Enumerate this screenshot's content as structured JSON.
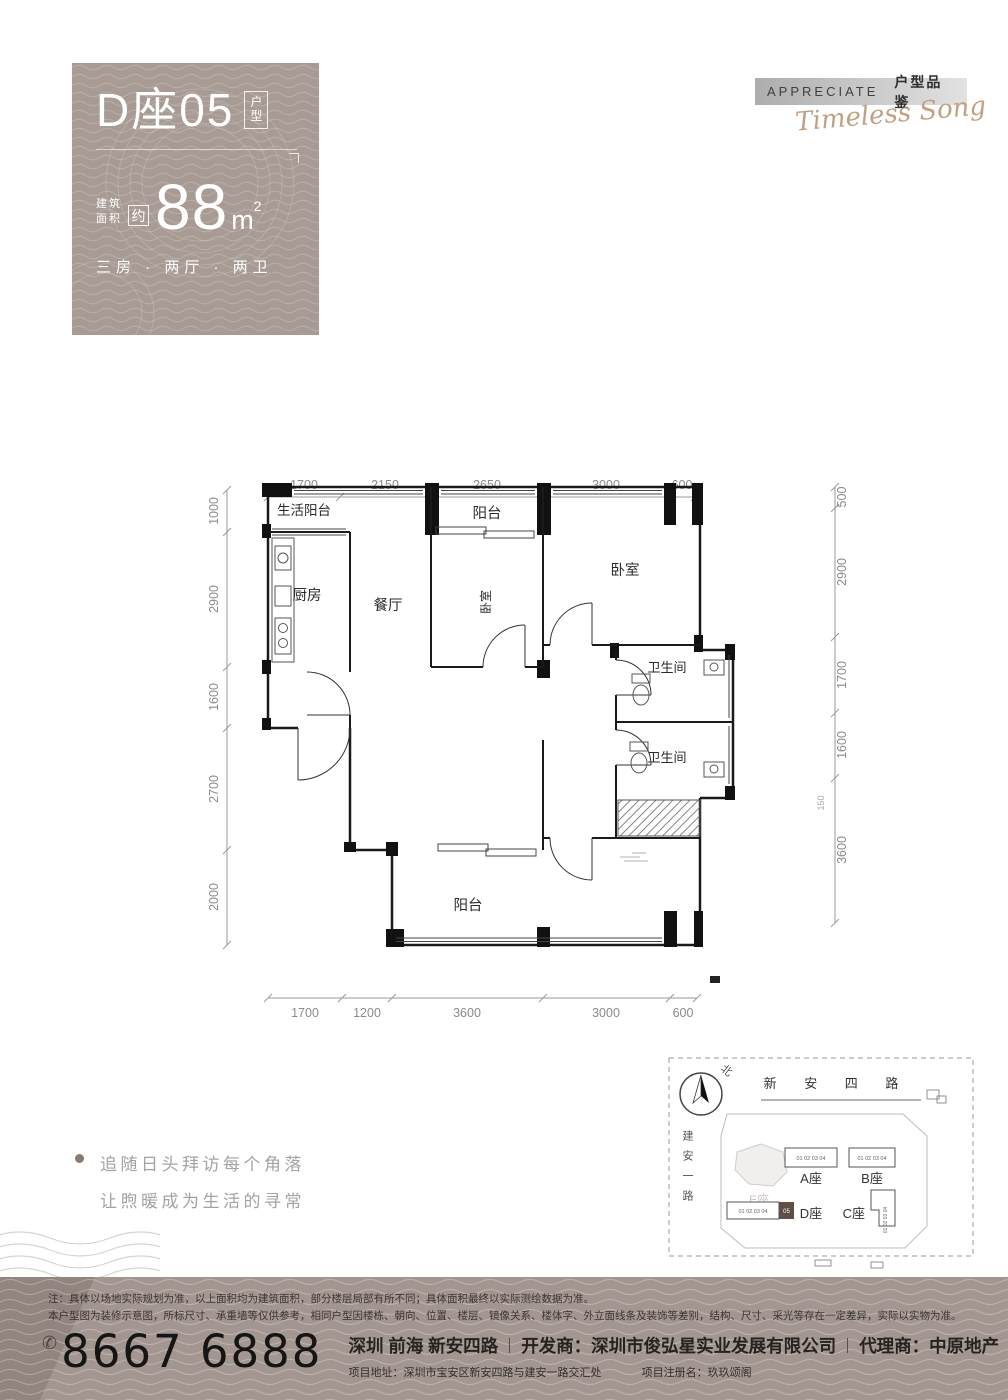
{
  "header": {
    "unit": "D座05",
    "unit_tag": "户型",
    "area_label_top": "建筑",
    "area_label_bottom": "面积",
    "approx": "约",
    "area_value": "88",
    "area_unit": "m",
    "area_exp": "2",
    "layout": "三房 · 两厅 · 两卫",
    "banner_en": "APPRECIATE",
    "banner_cn": "户型品鉴",
    "banner_script": "Timeless Song"
  },
  "floorplan": {
    "dims_top": [
      "1700",
      "2150",
      "2650",
      "3000",
      "600"
    ],
    "dims_bottom": [
      "1700",
      "1200",
      "3600",
      "3000",
      "600"
    ],
    "dims_left": [
      "1000",
      "2900",
      "1600",
      "2700",
      "2000"
    ],
    "dims_right": [
      "500",
      "2900",
      "1700",
      "1600",
      "3600"
    ],
    "small_dim": "150",
    "rooms": {
      "service_balcony": "生活阳台",
      "kitchen": "厨房",
      "dining": "餐厅",
      "balcony_top": "阳台",
      "bedroom_mid": "卧室",
      "bedroom_right": "卧室",
      "bath_1": "卫生间",
      "bath_2": "卫生间",
      "balcony_bottom": "阳台"
    }
  },
  "slogan": {
    "line1": "追随日头拜访每个角落",
    "line2": "让煦暖成为生活的寻常"
  },
  "sitemap": {
    "north": "北",
    "road_top": "新 安 四 路",
    "road_left": "建安一路",
    "e_label": "E座",
    "a_label": "A座",
    "b_label": "B座",
    "c_label": "C座",
    "d_label": "D座",
    "a_units": "01 02 03 04",
    "b_units": "01 02 03 04",
    "c_units": "01 02 03 04",
    "d_units": "01 02 03 04",
    "d_highlight_unit": "05"
  },
  "footer": {
    "note1": "注：具体以场地实际规划为准，以上面积均为建筑面积，部分楼层局部有所不同；具体面积最终以实际测绘数据为准。",
    "note2": "本户型图为装修示意图，所标尺寸、承重墙等仅供参考，相同户型因楼栋、朝向、位置、楼层、镜像关系、楼体字、外立面线条及装饰等差别，结构、尺寸、采光等存在一定差异，实际以实物为准。",
    "phone": "8667 6888",
    "location": "深圳 前海 新安四路",
    "developer": "开发商：深圳市俊弘星实业发展有限公司",
    "agent": "代理商：中原地产",
    "extra": "整合营销",
    "address": "项目地址：深圳市宝安区新安四路与建安一路交汇处",
    "registered": "项目注册名：玖玖颂阁"
  },
  "colors": {
    "taupe": "#a89b94",
    "footer_band": "#a39690",
    "accent_script": "#c2a183",
    "highlight_unit": "#5f4f47"
  }
}
